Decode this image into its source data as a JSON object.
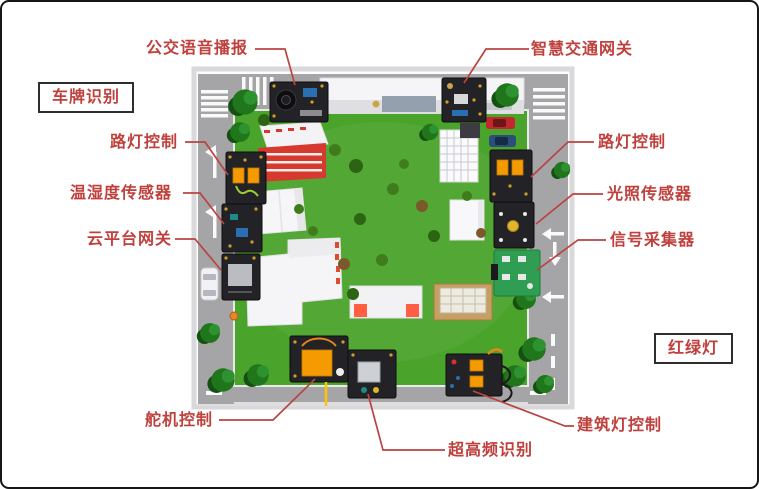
{
  "figure_title": "",
  "palette": {
    "label_red": "#bf403c",
    "line_red": "#b94441",
    "road_gray": "#a5a5a7",
    "sidewalk_gray": "#d9d9db",
    "grass_green": "#4aa42b",
    "module_black": "#232327",
    "pcb_green": "#2f9e52",
    "servo_orange": "#f59a00",
    "box_border": "#2e2e2e"
  },
  "labels": {
    "bus_voice": {
      "text": "公交语音播报",
      "boxed": false
    },
    "smart_traffic_gateway": {
      "text": "智慧交通网关",
      "boxed": false
    },
    "license_plate": {
      "text": "车牌识别",
      "boxed": true
    },
    "street_light_left": {
      "text": "路灯控制",
      "boxed": false
    },
    "temp_humidity": {
      "text": "温湿度传感器",
      "boxed": false
    },
    "cloud_gateway": {
      "text": "云平台网关",
      "boxed": false
    },
    "street_light_right": {
      "text": "路灯控制",
      "boxed": false
    },
    "light_sensor": {
      "text": "光照传感器",
      "boxed": false
    },
    "signal_collector": {
      "text": "信号采集器",
      "boxed": false
    },
    "traffic_light": {
      "text": "红绿灯",
      "boxed": true
    },
    "servo_control": {
      "text": "舵机控制",
      "boxed": false
    },
    "uhf_rfid": {
      "text": "超高频识别",
      "boxed": false
    },
    "building_light": {
      "text": "建筑灯控制",
      "boxed": false
    }
  }
}
